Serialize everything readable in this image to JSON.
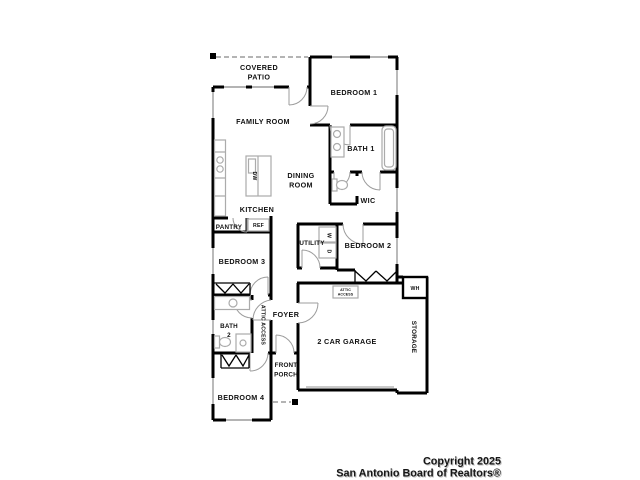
{
  "colors": {
    "background": "#ffffff",
    "wall": "#000000",
    "window": "#9c9c9c",
    "fixture": "#ababab",
    "label": "#111111",
    "footer": "#161616"
  },
  "labels": {
    "covered_patio": [
      "COVERED",
      "PATIO"
    ],
    "bedroom1": "BEDROOM 1",
    "family_room": "FAMILY ROOM",
    "bath1": "BATH 1",
    "dining_room": [
      "DINING",
      "ROOM"
    ],
    "wic": "WIC",
    "kitchen": "KITCHEN",
    "pantry": "PANTRY",
    "ref": "REF",
    "utility": "UTILITY",
    "washer": "W",
    "dryer": "D",
    "dishwasher": "DW",
    "bedroom2": "BEDROOM 2",
    "bedroom3": "BEDROOM 3",
    "water_heater": "WH",
    "foyer": "FOYER",
    "bath2": [
      "BATH",
      "2"
    ],
    "attic_access_hall": "ATTIC ACCESS",
    "attic_access_garage": [
      "ATTIC",
      "ACCESS"
    ],
    "garage": "2 CAR GARAGE",
    "storage": "STORAGE",
    "front_porch": [
      "FRONT",
      "PORCH"
    ],
    "bedroom4": "BEDROOM 4"
  },
  "footer": {
    "line1": "Copyright 2025",
    "line2": "San Antonio Board of Realtors®"
  }
}
